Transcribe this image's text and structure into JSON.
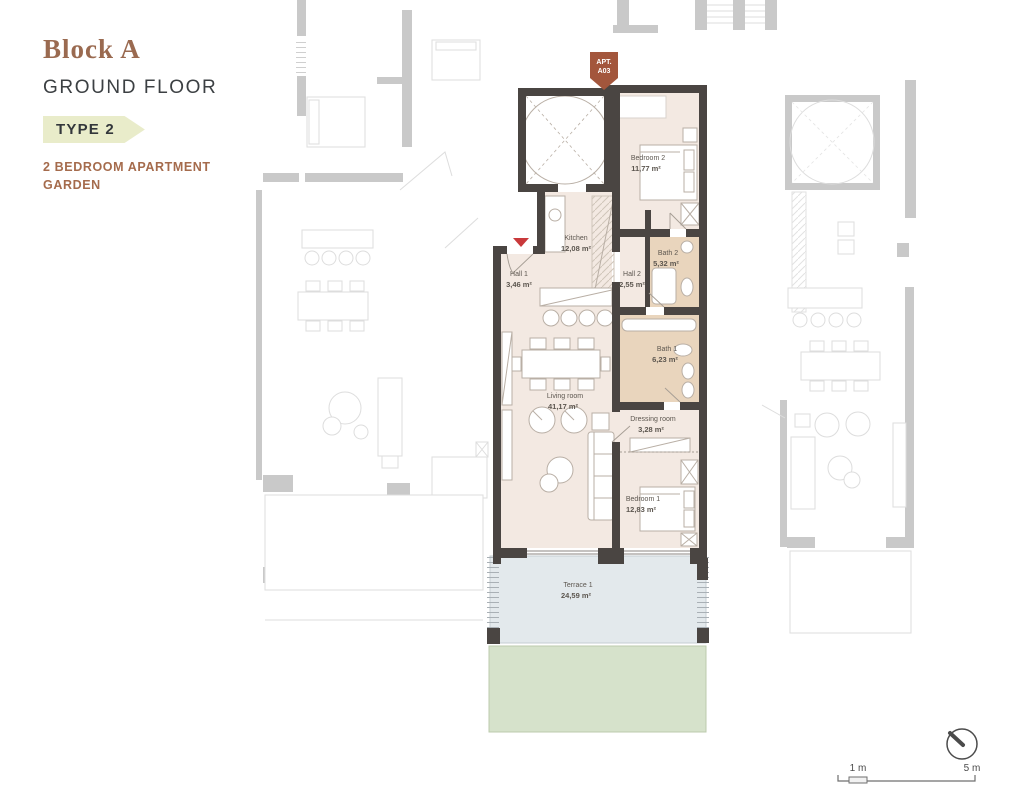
{
  "header": {
    "block": "Block A",
    "floor": "GROUND FLOOR",
    "type_badge": "TYPE 2",
    "desc1": "2 BEDROOM APARTMENT",
    "desc2": "GARDEN"
  },
  "apt_marker": {
    "line1": "APT.",
    "line2": "A03"
  },
  "rooms": [
    {
      "name": "Bedroom 2",
      "area": "11,77 m²"
    },
    {
      "name": "Kitchen",
      "area": "12,08 m²"
    },
    {
      "name": "Hall 1",
      "area": "3,46 m²"
    },
    {
      "name": "Hall 2",
      "area": "2,55 m²"
    },
    {
      "name": "Bath 2",
      "area": "5,32 m²"
    },
    {
      "name": "Bath 1",
      "area": "6,23 m²"
    },
    {
      "name": "Living room",
      "area": "41,17 m²"
    },
    {
      "name": "Dressing room",
      "area": "3,28 m²"
    },
    {
      "name": "Bedroom 1",
      "area": "12,83 m²"
    },
    {
      "name": "Terrace 1",
      "area": "24,59 m²"
    }
  ],
  "scale_bar": {
    "m1": "1 m",
    "m5": "5 m"
  },
  "colors": {
    "accent-brown": "#9a6a50",
    "heading": "#3c4043",
    "badge-bg": "#e9ecca",
    "badge-text": "#33373b",
    "desc": "#a56b4c",
    "wall": "#4a4542",
    "room": "#f3e9e2",
    "bath": "#e9d5bd",
    "terrace": "#e3e9ec",
    "garden": "#d6e2cb",
    "marker": "#a3563c",
    "entry-red": "#c9393b",
    "furn": "#b9afa5",
    "bg-wall": "#c9c9c9",
    "bg-line": "#dddddd",
    "label": "#5c564f"
  }
}
